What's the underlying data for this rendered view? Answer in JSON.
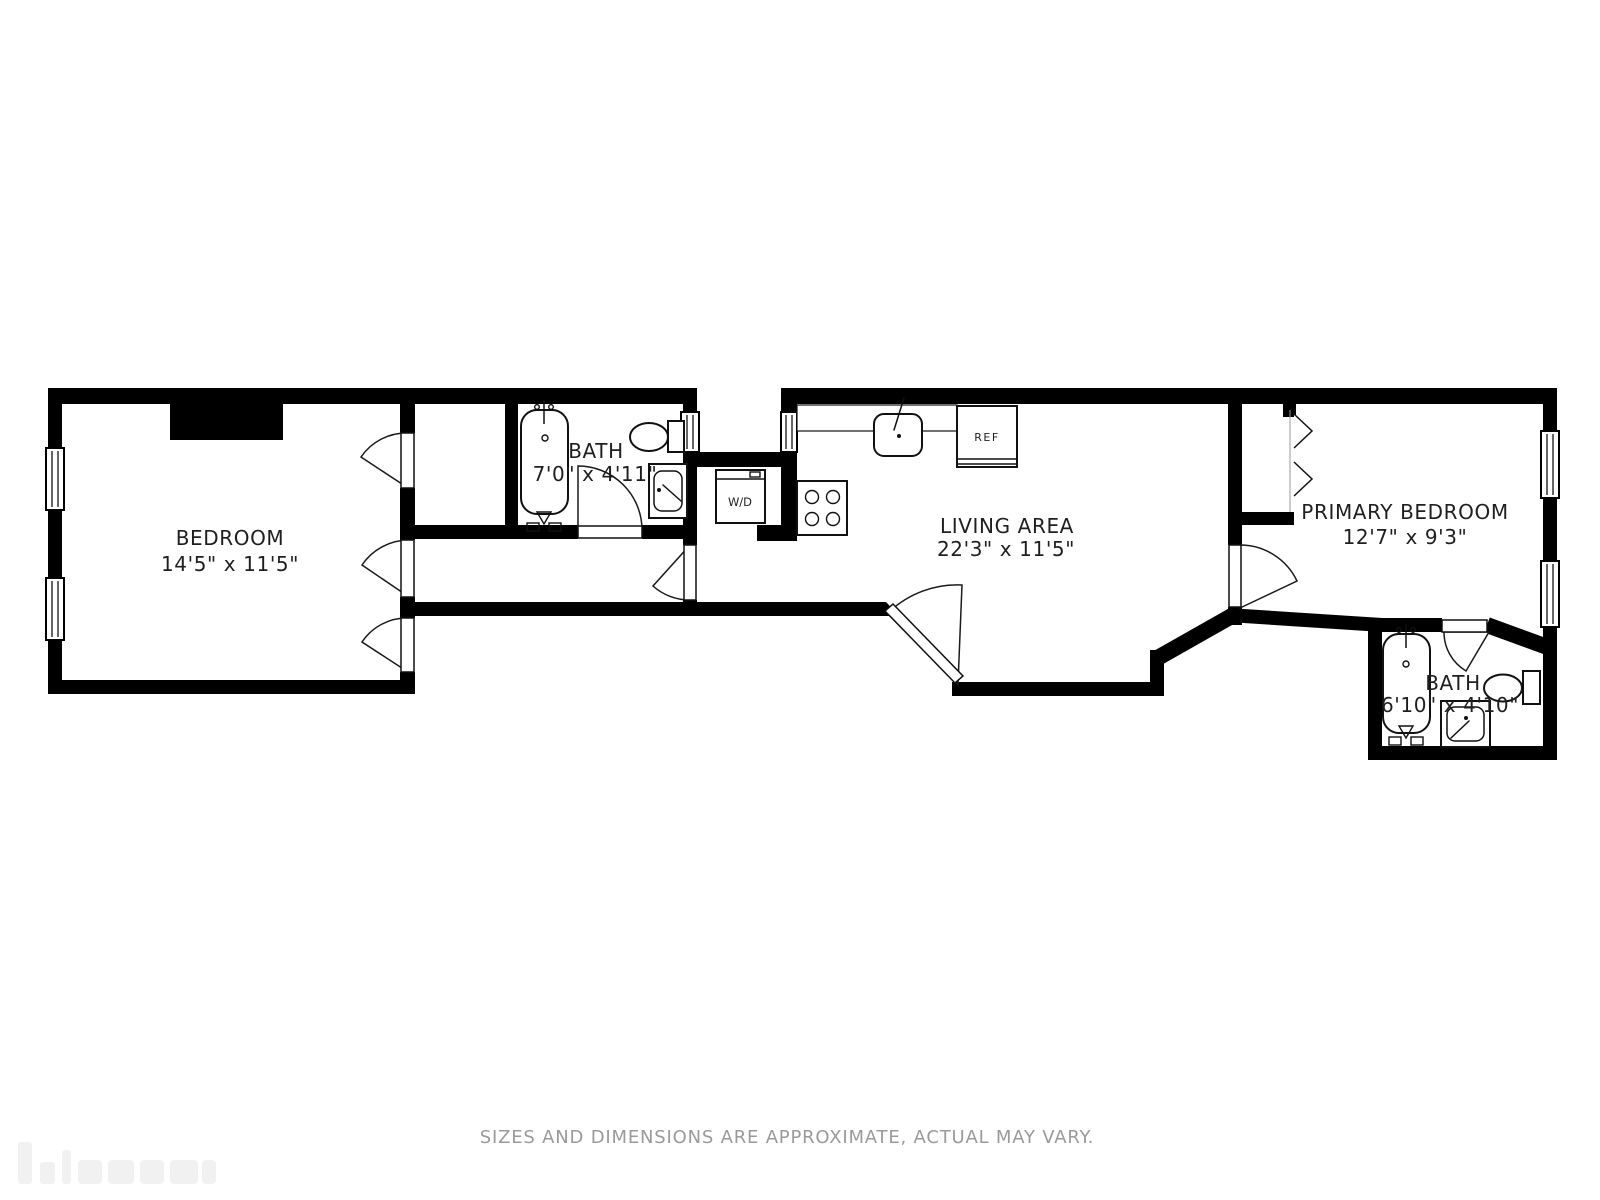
{
  "floorplan": {
    "background": "#ffffff",
    "wall_color": "#000000",
    "label_color": "#1f1f1f",
    "rooms": [
      {
        "name": "BEDROOM",
        "dimensions": "14'5\" x 11'5\""
      },
      {
        "name": "BATH",
        "dimensions": "7'0\" x 4'11\""
      },
      {
        "name": "LIVING AREA",
        "dimensions": "22'3\" x 11'5\""
      },
      {
        "name": "PRIMARY BEDROOM",
        "dimensions": "12'7\" x 9'3\""
      },
      {
        "name": "BATH",
        "dimensions": "6'10\" x 4'10\""
      }
    ],
    "appliances": {
      "washer_dryer": "W/D",
      "refrigerator": "REF"
    },
    "disclaimer": {
      "text": "SIZES AND DIMENSIONS ARE APPROXIMATE, ACTUAL MAY VARY.",
      "color": "#9a9a9a"
    }
  }
}
